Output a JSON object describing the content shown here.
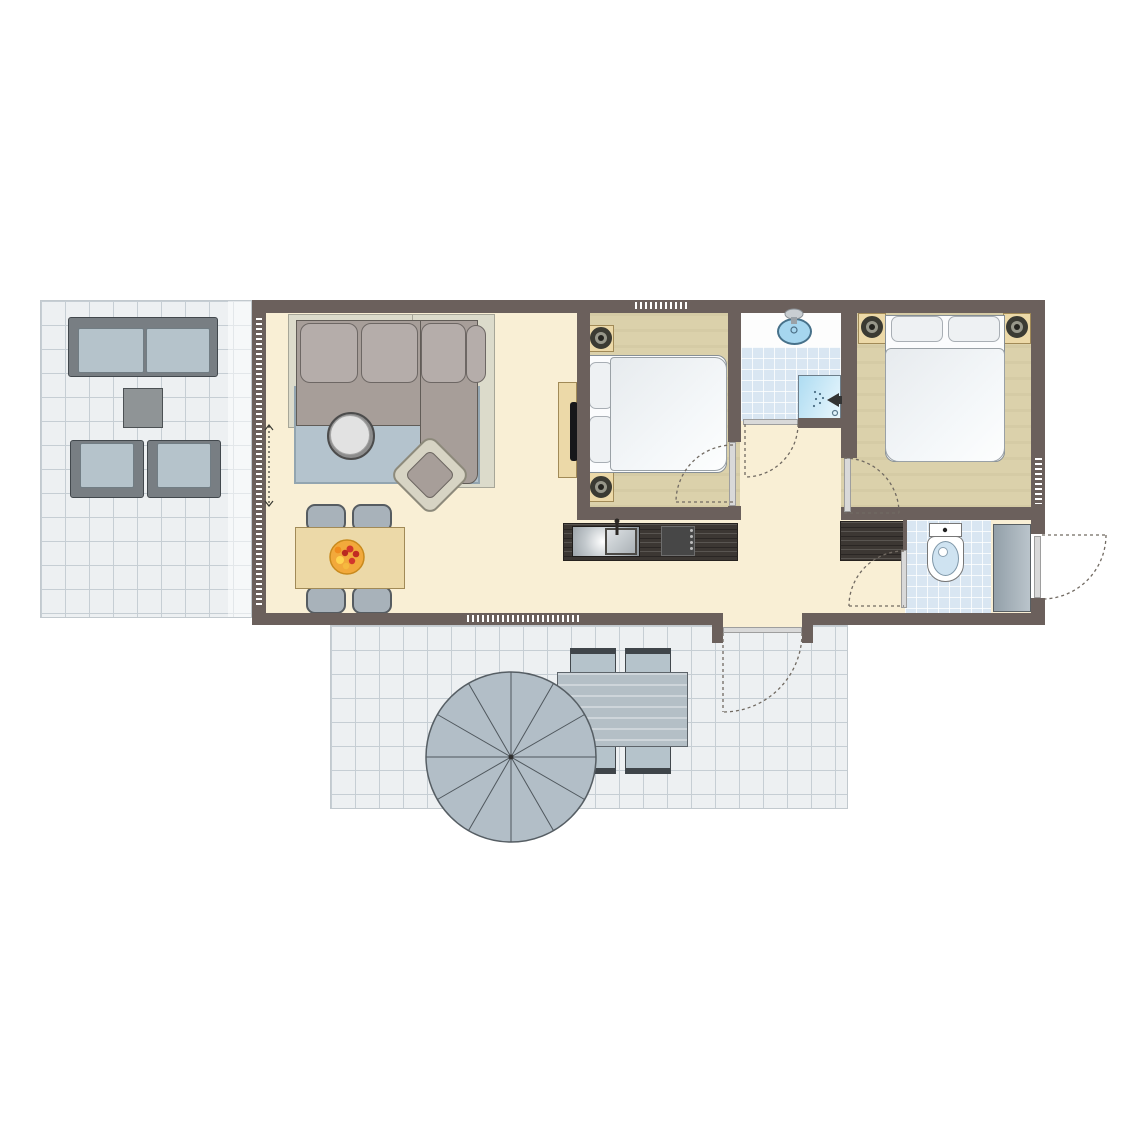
{
  "title": "apartment-floor-plan",
  "palette": {
    "wall": "#6b605c",
    "floor": "#f9efd5",
    "bedroomFloor": "#dbd1ab",
    "terraceTile": "#edf0f2",
    "terraceLine": "#c6ced4",
    "bathTile": "#d9e6f2",
    "wood": "#ecd9a8",
    "counter": "#3c3733",
    "sofa": "#a79e99",
    "sofaCushion": "#b5adaa",
    "sofaBase": "#dcdbcb",
    "rug": "#b4c3cd",
    "chair": "#a8b2ba",
    "outdoor": "#b5c3cb",
    "outdoorFrame": "#787e83",
    "bed": "#eef1f3",
    "water": "#a6d6ef",
    "shower": "#bfe2f2",
    "storage": "#95a2ab",
    "door": "#d9d9d9",
    "arc": "#716a62",
    "parasol": "#b2bec7",
    "fruitBowl": "#f2a93b"
  },
  "rooms": [
    {
      "id": "living-dining-room",
      "floor": "cream",
      "furniture": [
        "corner-sofa",
        "sofa-platform",
        "rug",
        "round-coffee-table",
        "armchair",
        "tv-cabinet",
        "dining-table",
        "dining-chair-x4",
        "fruit-bowl",
        "curtain-marking"
      ]
    },
    {
      "id": "kitchen",
      "floor": "cream",
      "furniture": [
        "counter-with-sink",
        "cooktop",
        "side-counter"
      ]
    },
    {
      "id": "bedroom-1",
      "floor": "tan",
      "furniture": [
        "double-bed",
        "pillow-x2",
        "nightstand-x2",
        "lamp-x2"
      ]
    },
    {
      "id": "bedroom-2",
      "floor": "tan",
      "furniture": [
        "double-bed",
        "pillow-x2",
        "nightstand-x2",
        "lamp-x2"
      ]
    },
    {
      "id": "bathroom",
      "floor": "blue-tile",
      "furniture": [
        "vanity-washbasin",
        "shower-corner"
      ]
    },
    {
      "id": "toilet-room",
      "floor": "blue-tile",
      "furniture": [
        "toilet",
        "storage-cupboard"
      ]
    },
    {
      "id": "hallway",
      "floor": "cream",
      "furniture": []
    },
    {
      "id": "terrace-west",
      "floor": "grey-tile",
      "furniture": [
        "garden-sofa",
        "garden-side-table",
        "garden-chair-x2"
      ]
    },
    {
      "id": "terrace-south",
      "floor": "grey-tile",
      "furniture": [
        "parasol",
        "garden-dining-table",
        "garden-chair-x4"
      ]
    }
  ],
  "doors": [
    "front-door-right-wall",
    "terrace-door-south-wall",
    "bedroom-1-door",
    "bedroom-2-door",
    "bathroom-door",
    "toilet-door"
  ],
  "windows": [
    "west-window-wall",
    "bedroom-1-top-window",
    "living-room-south-window",
    "bedroom-2-right-window"
  ]
}
